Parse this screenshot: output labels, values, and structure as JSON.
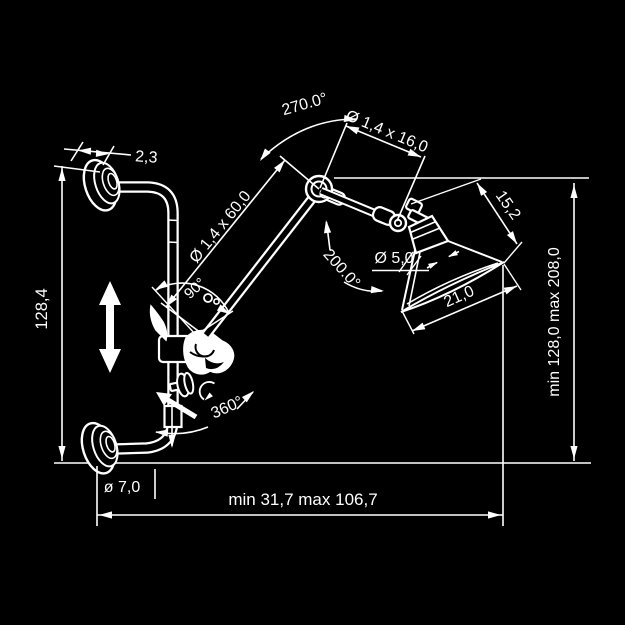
{
  "canvas": {
    "background": "#000000",
    "line_color": "#ffffff",
    "width": 625,
    "height": 625
  },
  "drawing": {
    "type": "technical-dimension-diagram",
    "subject": "wall-mounted articulated swing-arm lamp, side view",
    "annotations": {
      "flange_thickness": "2,3",
      "rail_height": "128,4",
      "tube_diameter": "ø 7,0",
      "arm_lower": "Ø 1,4 x 60,0",
      "arm_upper": "Ø 1,4 x 16,0",
      "socket_diameter": "Ø 5,0",
      "shade_side": "15,2",
      "shade_opening": "21,0",
      "angle_elbow": "270.0°",
      "angle_head": "200.0°",
      "angle_arm": "90°",
      "angle_rotation": "360°",
      "height_range": "min 128,0  max 208,0",
      "reach_range": "min 31,7   max 106,7"
    }
  }
}
